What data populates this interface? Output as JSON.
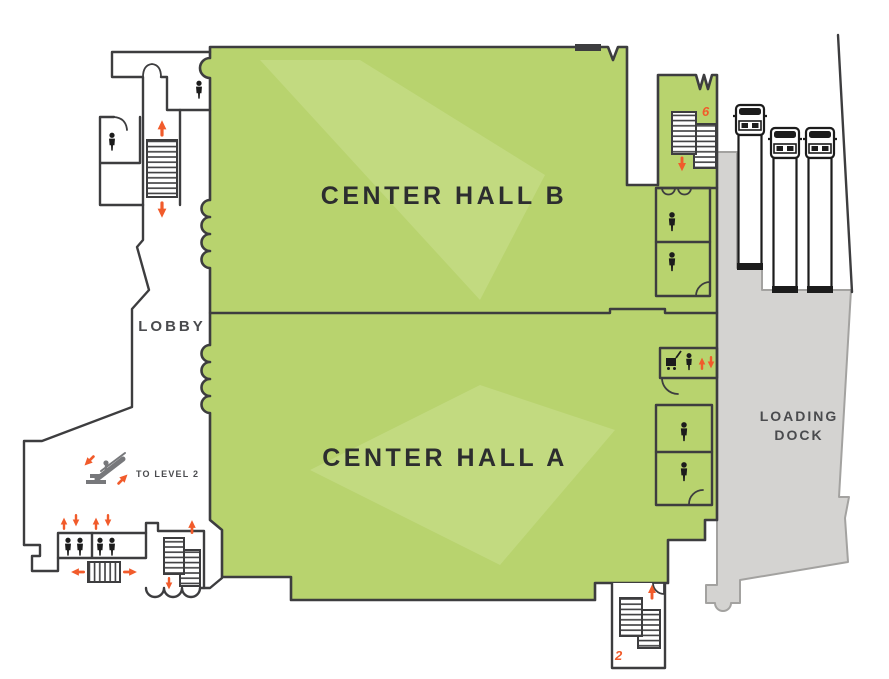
{
  "palette": {
    "hall_green": "#b8d36e",
    "hall_green_light": "#cfe296",
    "wall": "#3d3d3f",
    "dock_gray": "#d4d3d1",
    "dock_edge": "#a3a2a0",
    "orange": "#f15b2b",
    "icon_black": "#1c1c1c",
    "label_dark": "#2c2d2f",
    "label_gray": "#4a4b4e",
    "escalator_gray": "#77787b"
  },
  "labels": {
    "hall_b": "CENTER HALL B",
    "hall_a": "CENTER HALL A",
    "lobby": "LOBBY",
    "loading_line1": "LOADING",
    "loading_line2": "DOCK",
    "to_level_2": "TO LEVEL 2"
  },
  "stair_numbers": {
    "northeast": "6",
    "southeast": "2"
  },
  "trucks": {
    "count": 3
  },
  "icons": {
    "restroom": "person-silhouette",
    "stairs": "tread-striped-rectangle",
    "escalator": "diagonal-escalator-glyph",
    "freight_elevator": "cart-and-person",
    "truck": "top-view-semi-truck",
    "direction_arrow": "orange-arrow"
  }
}
